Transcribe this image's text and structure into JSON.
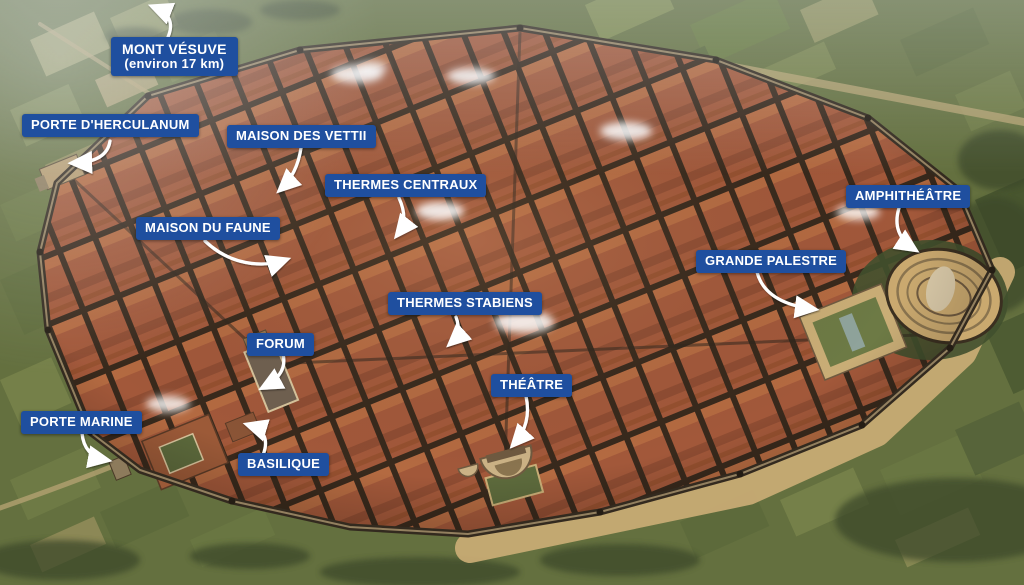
{
  "map": {
    "subject": "Pompeii aerial reconstruction map",
    "language": "fr"
  },
  "colors": {
    "label_background": "#1f4f9f",
    "label_text": "#ffffff",
    "arrow": "#ffffff",
    "rooftops": "#a2583a",
    "countryside": "#64703f",
    "city_wall": "#332a1f",
    "escarpment": "#c7ab74"
  },
  "labels": [
    {
      "id": "mont-vesuve",
      "text": "MONT VÉSUVE",
      "subtext": "(environ 17 km)"
    },
    {
      "id": "porte-herculanum",
      "text": "PORTE D'HERCULANUM"
    },
    {
      "id": "maison-des-vettii",
      "text": "MAISON DES VETTII"
    },
    {
      "id": "thermes-centraux",
      "text": "THERMES CENTRAUX"
    },
    {
      "id": "maison-du-faune",
      "text": "MAISON DU FAUNE"
    },
    {
      "id": "amphitheatre",
      "text": "AMPHITHÉÂTRE"
    },
    {
      "id": "grande-palestre",
      "text": "GRANDE PALESTRE"
    },
    {
      "id": "thermes-stabiens",
      "text": "THERMES STABIENS"
    },
    {
      "id": "forum",
      "text": "FORUM"
    },
    {
      "id": "theatre",
      "text": "THÉÂTRE"
    },
    {
      "id": "porte-marine",
      "text": "PORTE MARINE"
    },
    {
      "id": "basilique",
      "text": "BASILIQUE"
    }
  ]
}
